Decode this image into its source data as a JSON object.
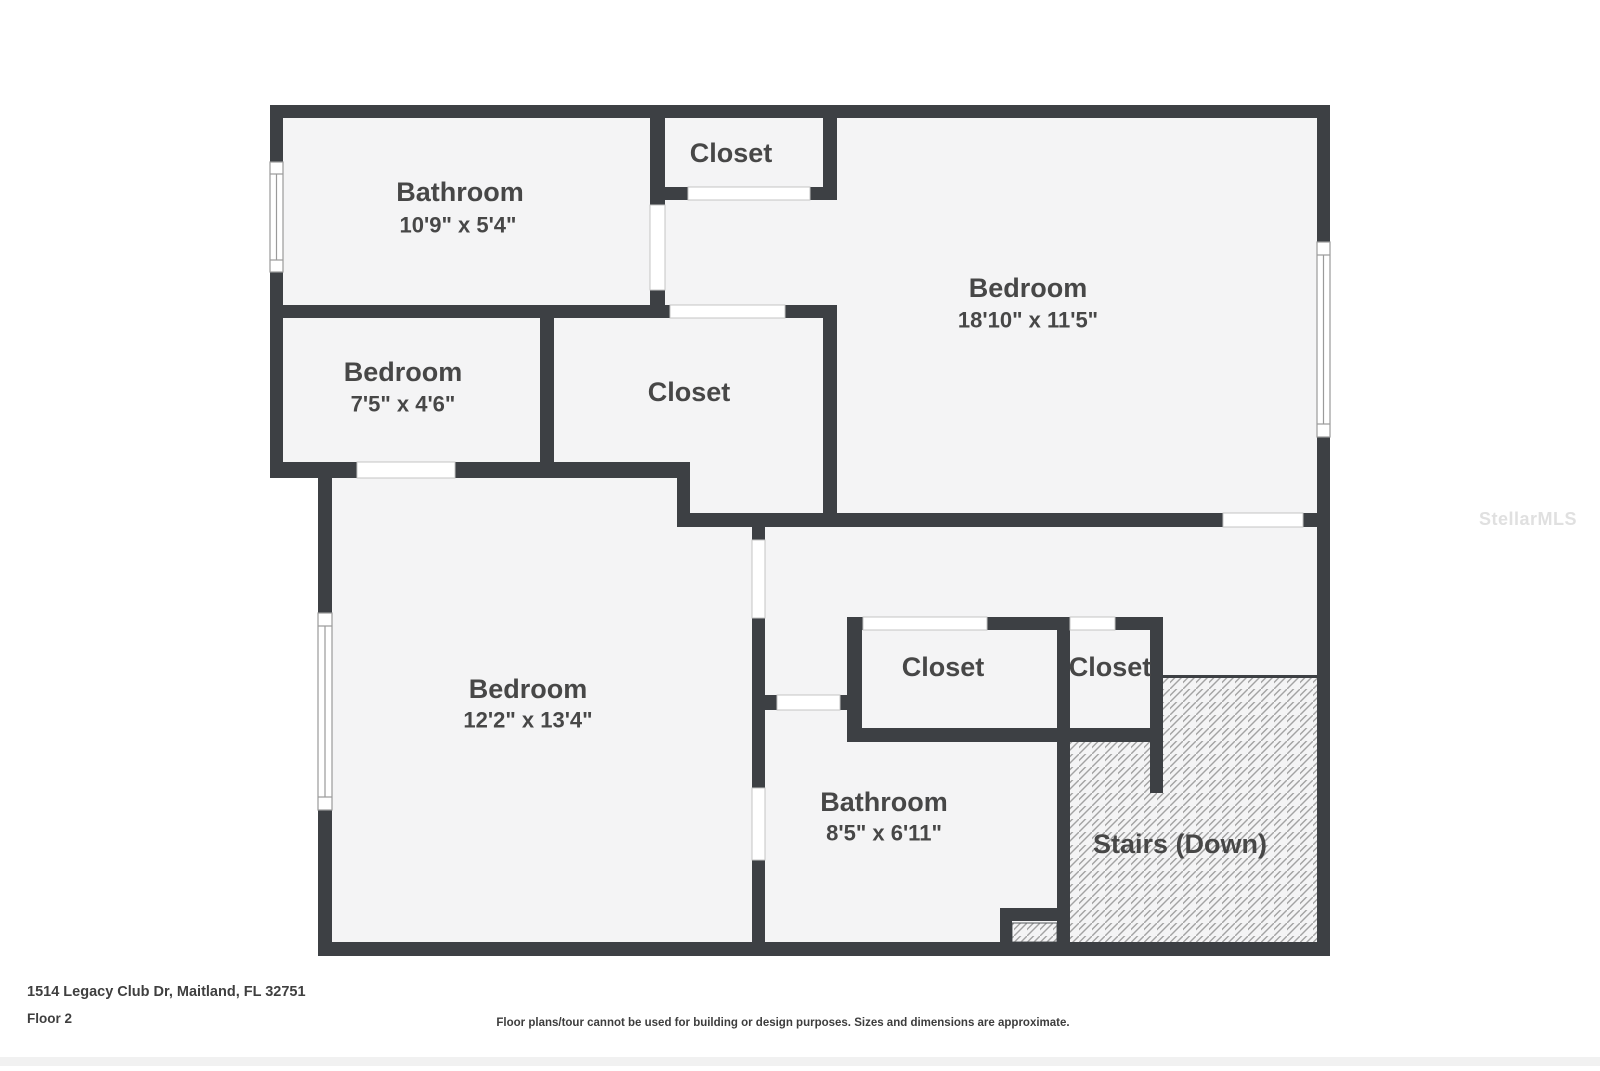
{
  "plan": {
    "colors": {
      "wall": "#3d4044",
      "floor": "#f4f4f5",
      "hatch_line": "#a3a3a3",
      "label": "#474747",
      "opening_border": "#c4c4c4",
      "window_border": "#9a9a9a"
    },
    "rooms": [
      {
        "name": "Bathroom",
        "dims": "10'9\" x 5'4\""
      },
      {
        "name": "Closet",
        "dims": ""
      },
      {
        "name": "Bedroom",
        "dims": "18'10\" x 11'5\""
      },
      {
        "name": "Bedroom",
        "dims": "7'5\" x 4'6\""
      },
      {
        "name": "Closet",
        "dims": ""
      },
      {
        "name": "Bedroom",
        "dims": "12'2\" x 13'4\""
      },
      {
        "name": "Closet",
        "dims": ""
      },
      {
        "name": "Closet",
        "dims": ""
      },
      {
        "name": "Bathroom",
        "dims": "8'5\" x 6'11\""
      },
      {
        "name": "Stairs (Down)",
        "dims": ""
      }
    ]
  },
  "footer": {
    "address": "1514 Legacy Club Dr, Maitland, FL 32751",
    "floor": "Floor 2",
    "disclaimer": "Floor plans/tour cannot be used for building or design purposes. Sizes and dimensions are approximate."
  },
  "watermark": "StellarMLS"
}
